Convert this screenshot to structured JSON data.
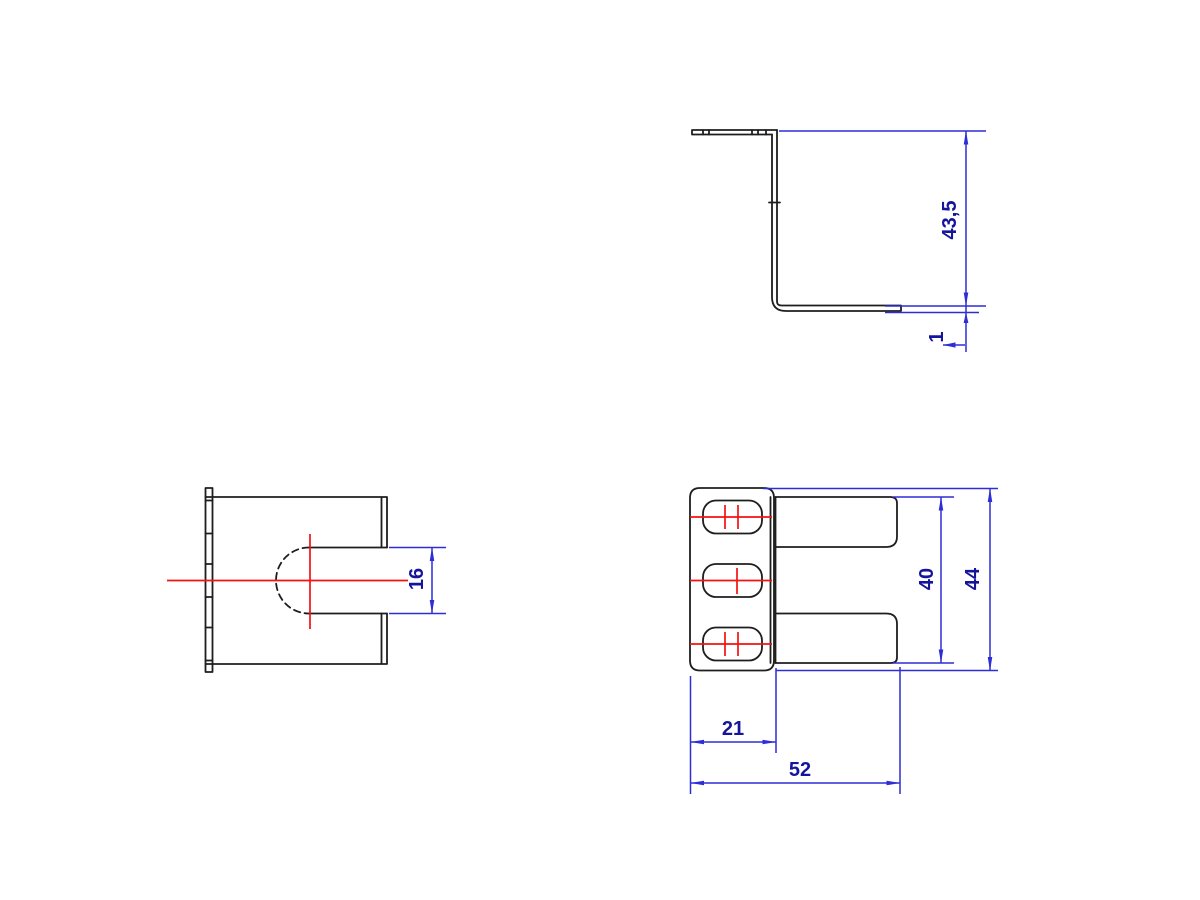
{
  "colors": {
    "geometry": "#1e1e1e",
    "dimension": "#2e2ed6",
    "dimension_text": "#15159c",
    "centerline": "#f41212",
    "background": "#ffffff"
  },
  "dimensions": {
    "side_height": "43,5",
    "side_thickness": "1",
    "front_slot_width": "16",
    "plan_finger_span": "40",
    "plan_overall_width": "44",
    "plan_flange_depth": "21",
    "plan_overall_depth": "52"
  }
}
